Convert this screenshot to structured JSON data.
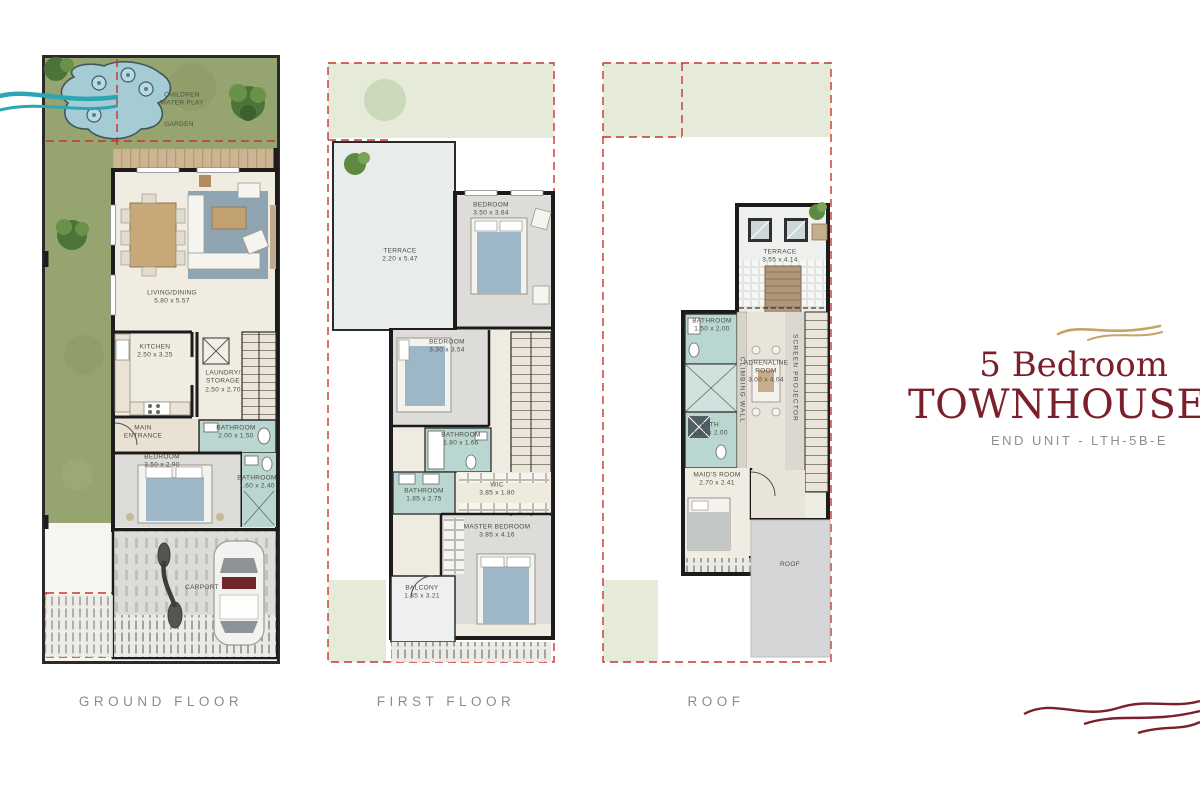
{
  "brand": {
    "title_line1": "5 Bedroom",
    "title_line2": "TOWNHOUSE",
    "subtitle": "END UNIT - LTH-5B-E"
  },
  "colors": {
    "brand_maroon": "#7b1f2b",
    "brand_gold": "#c7a366",
    "plot_dash_red": "#c9342c",
    "water_teal": "#2ba7b4",
    "grass_green": "#96a470",
    "pool_blue": "#a5cbd4",
    "bath_teal": "#b9d6d0",
    "caption_gray": "#8c8c8c"
  },
  "ground": {
    "label": "GROUND FLOOR",
    "water_play": "CHILDREN WATER PLAY",
    "garden": "GARDEN",
    "living": {
      "name": "LIVING/DINING",
      "dims": "5.80 x 5.57"
    },
    "kitchen": {
      "name": "KITCHEN",
      "dims": "2.50 x 3.25"
    },
    "laundry": {
      "name": "LAUNDRY/ STORAGE",
      "dims": "2.50 x 2.70"
    },
    "entrance": {
      "name": "MAIN ENTRANCE"
    },
    "bath1": {
      "name": "BATHROOM",
      "dims": "2.00 x 1.50"
    },
    "bedroom": {
      "name": "BEDROOM",
      "dims": "3.50 x 2.90"
    },
    "bath2": {
      "name": "BATHROOM",
      "dims": "1.60 x 2.40"
    },
    "carport": {
      "name": "CARPORT"
    }
  },
  "first": {
    "label": "FIRST FLOOR",
    "terrace": {
      "name": "TERRACE",
      "dims": "2.20 x 5.47"
    },
    "bedroom1": {
      "name": "BEDROOM",
      "dims": "3.50 x 3.64"
    },
    "bedroom2": {
      "name": "BEDROOM",
      "dims": "3.30 x 3.54"
    },
    "bath1": {
      "name": "BATHROOM",
      "dims": "1.80 x 1.66"
    },
    "bath2": {
      "name": "BATHROOM",
      "dims": "1.85 x 2.75"
    },
    "wic": {
      "name": "WIC",
      "dims": "3.85 x 1.80"
    },
    "master": {
      "name": "MASTER BEDROOM",
      "dims": "3.85 x 4.16"
    },
    "balcony": {
      "name": "BALCONY",
      "dims": "1.85 x 3.21"
    }
  },
  "roof": {
    "label": "ROOF",
    "terrace": {
      "name": "TERRACE",
      "dims": "3.55 x 4.14"
    },
    "bath1": {
      "name": "BATHROOM",
      "dims": "1.50 x 2.00"
    },
    "climbing": "CLIMBING WALL",
    "adrenaline": {
      "name": "ADRENALINE ROOM",
      "dims": "3.00 x 4.04"
    },
    "projector": "SCREEN PROJECTOR",
    "bath2": {
      "name": "BATH",
      "dims": "1.50 x 2.00"
    },
    "maid": {
      "name": "MAID'S ROOM",
      "dims": "2.70 x 2.41"
    },
    "roof_area": "ROOF"
  }
}
